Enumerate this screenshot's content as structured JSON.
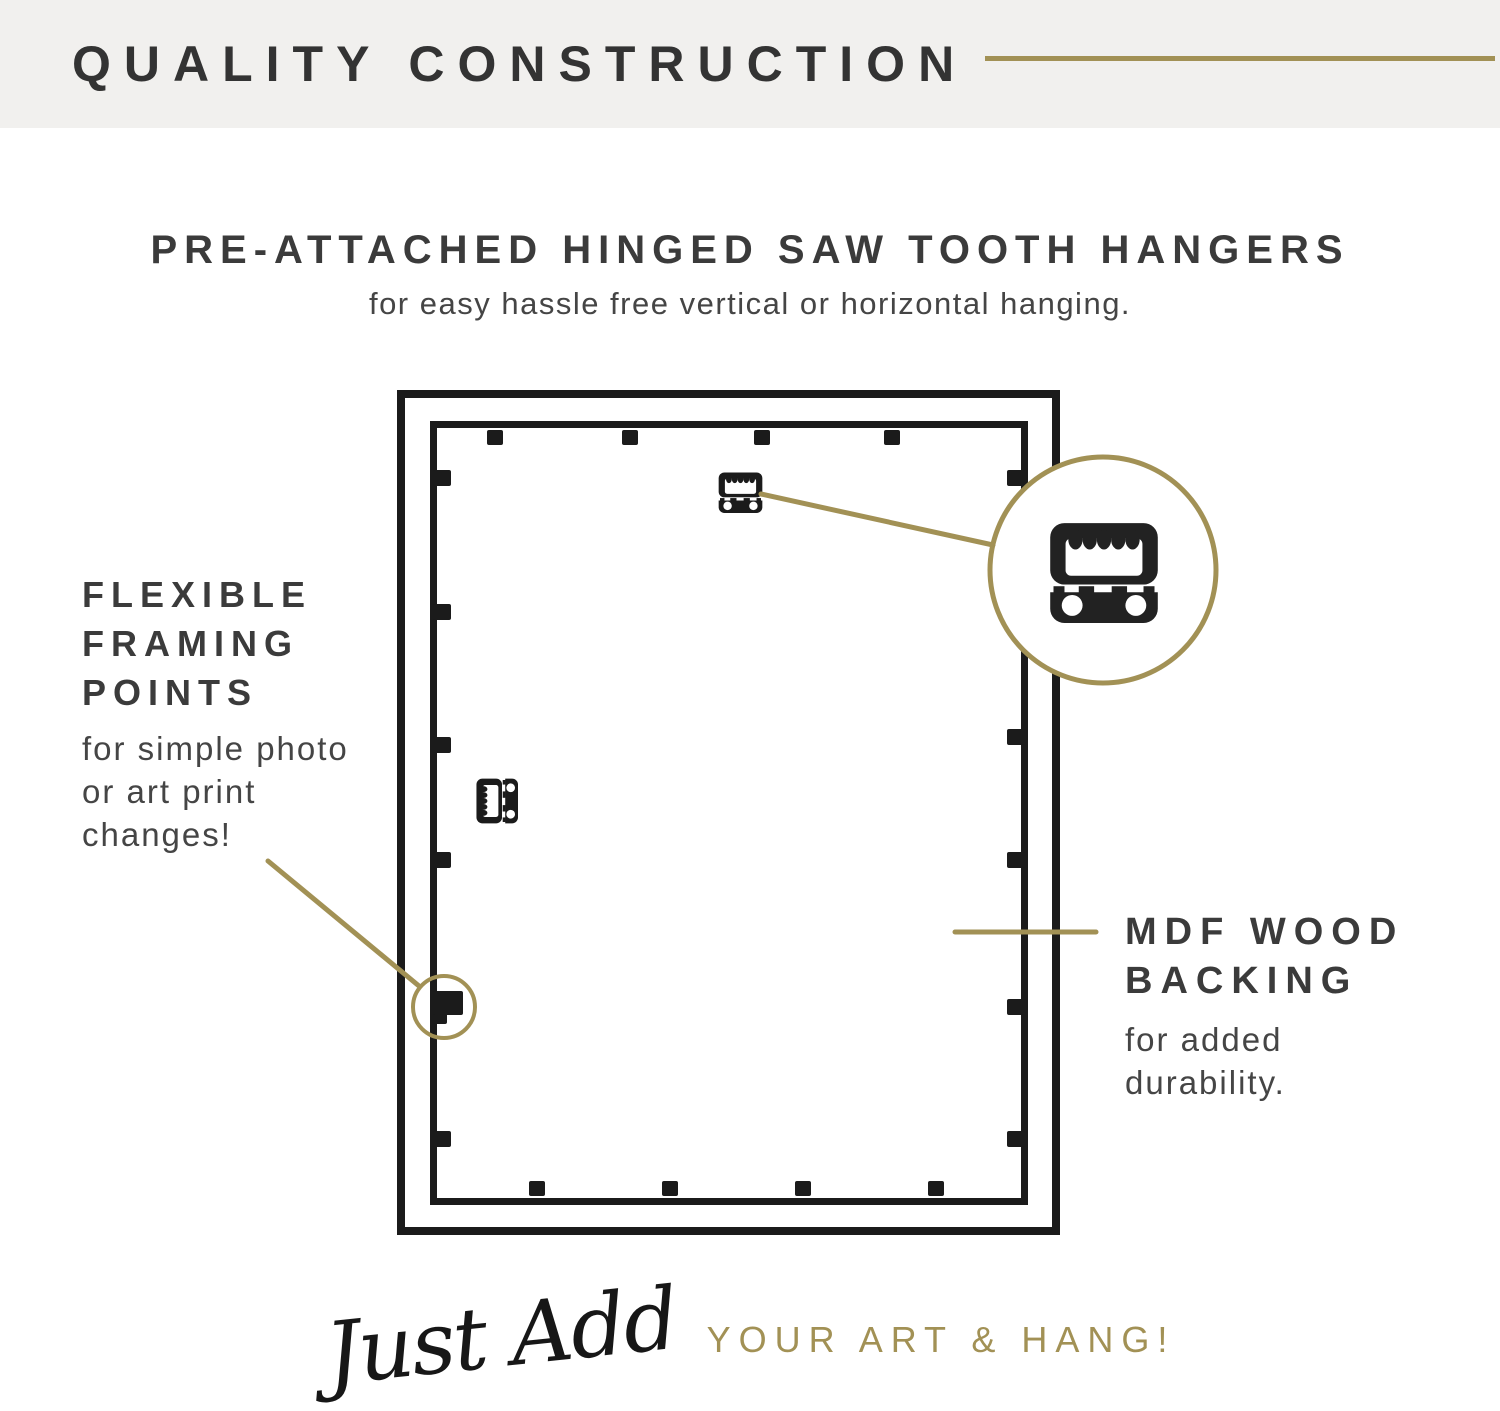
{
  "header": {
    "title": "QUALITY CONSTRUCTION"
  },
  "hero": {
    "title": "PRE-ATTACHED HINGED SAW TOOTH HANGERS",
    "subtitle": "for easy hassle free vertical or horizontal hanging."
  },
  "callouts": {
    "left": {
      "title_lines": [
        "FLEXIBLE",
        "FRAMING",
        "POINTS"
      ],
      "body_lines": [
        "for simple photo",
        "or art print",
        "changes!"
      ]
    },
    "right": {
      "title_lines": [
        "MDF WOOD",
        "BACKING"
      ],
      "body_lines": [
        "for added",
        "durability."
      ]
    }
  },
  "footer": {
    "script_text": "Just Add",
    "caps_text": "YOUR ART & HANG!"
  },
  "icons": {
    "sawtooth_hanger": "sawtooth-hanger-icon",
    "hinged_hanger": "hinged-sawtooth-hanger-icon",
    "framing_point": "framing-point",
    "magnified_hanger": "magnified-sawtooth-hanger-icon"
  },
  "colors": {
    "accent_gold": "#a29155",
    "ink_dark": "#3a3a3a",
    "body_gray": "#454545",
    "diagram_black": "#1b1b1b",
    "header_bg": "#f1f0ee",
    "page_bg": "#ffffff"
  }
}
